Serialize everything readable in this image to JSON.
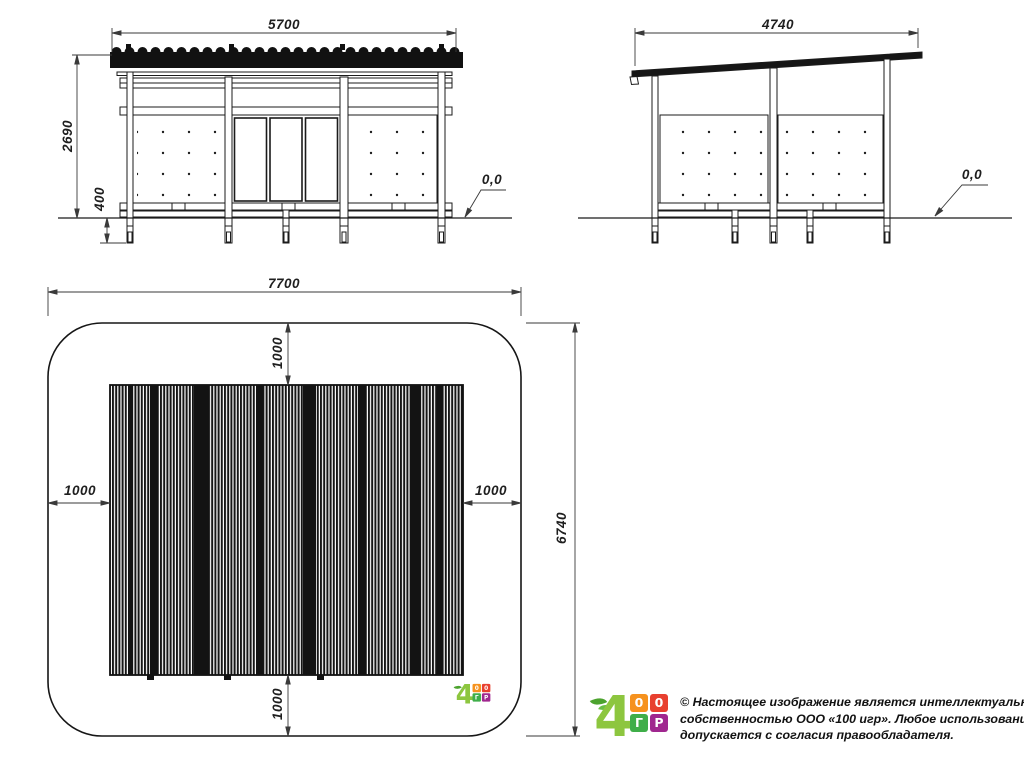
{
  "document": {
    "type": "technical-drawing",
    "subject": "shelter pavilion with plan safety zone"
  },
  "views": {
    "front_elevation": {
      "width_mm": "5700",
      "height_mm": "2690",
      "foundation_depth_mm": "400",
      "ground_level": "0,0"
    },
    "side_elevation": {
      "depth_mm": "4740",
      "ground_level": "0,0"
    },
    "plan": {
      "zone_width_mm": "7700",
      "zone_depth_mm": "6740",
      "clearance_top_mm": "1000",
      "clearance_bottom_mm": "1000",
      "clearance_left_mm": "1000",
      "clearance_right_mm": "1000"
    }
  },
  "logo": {
    "glyph": "4",
    "squares": [
      "0",
      "0",
      "Г",
      "Р"
    ],
    "colors": {
      "glyph": "#8DC63F",
      "leaf": "#4CA32E",
      "square_orange": "#F6921E",
      "square_red": "#E8402F",
      "square_green": "#3FAE49",
      "square_purple": "#A0278F"
    }
  },
  "copyright": {
    "line1": "© Настоящее изображение является интеллектуальной",
    "line2": "собственностью ООО «100 игр».  Любое использование",
    "line3": "допускается с согласия правообладателя."
  }
}
